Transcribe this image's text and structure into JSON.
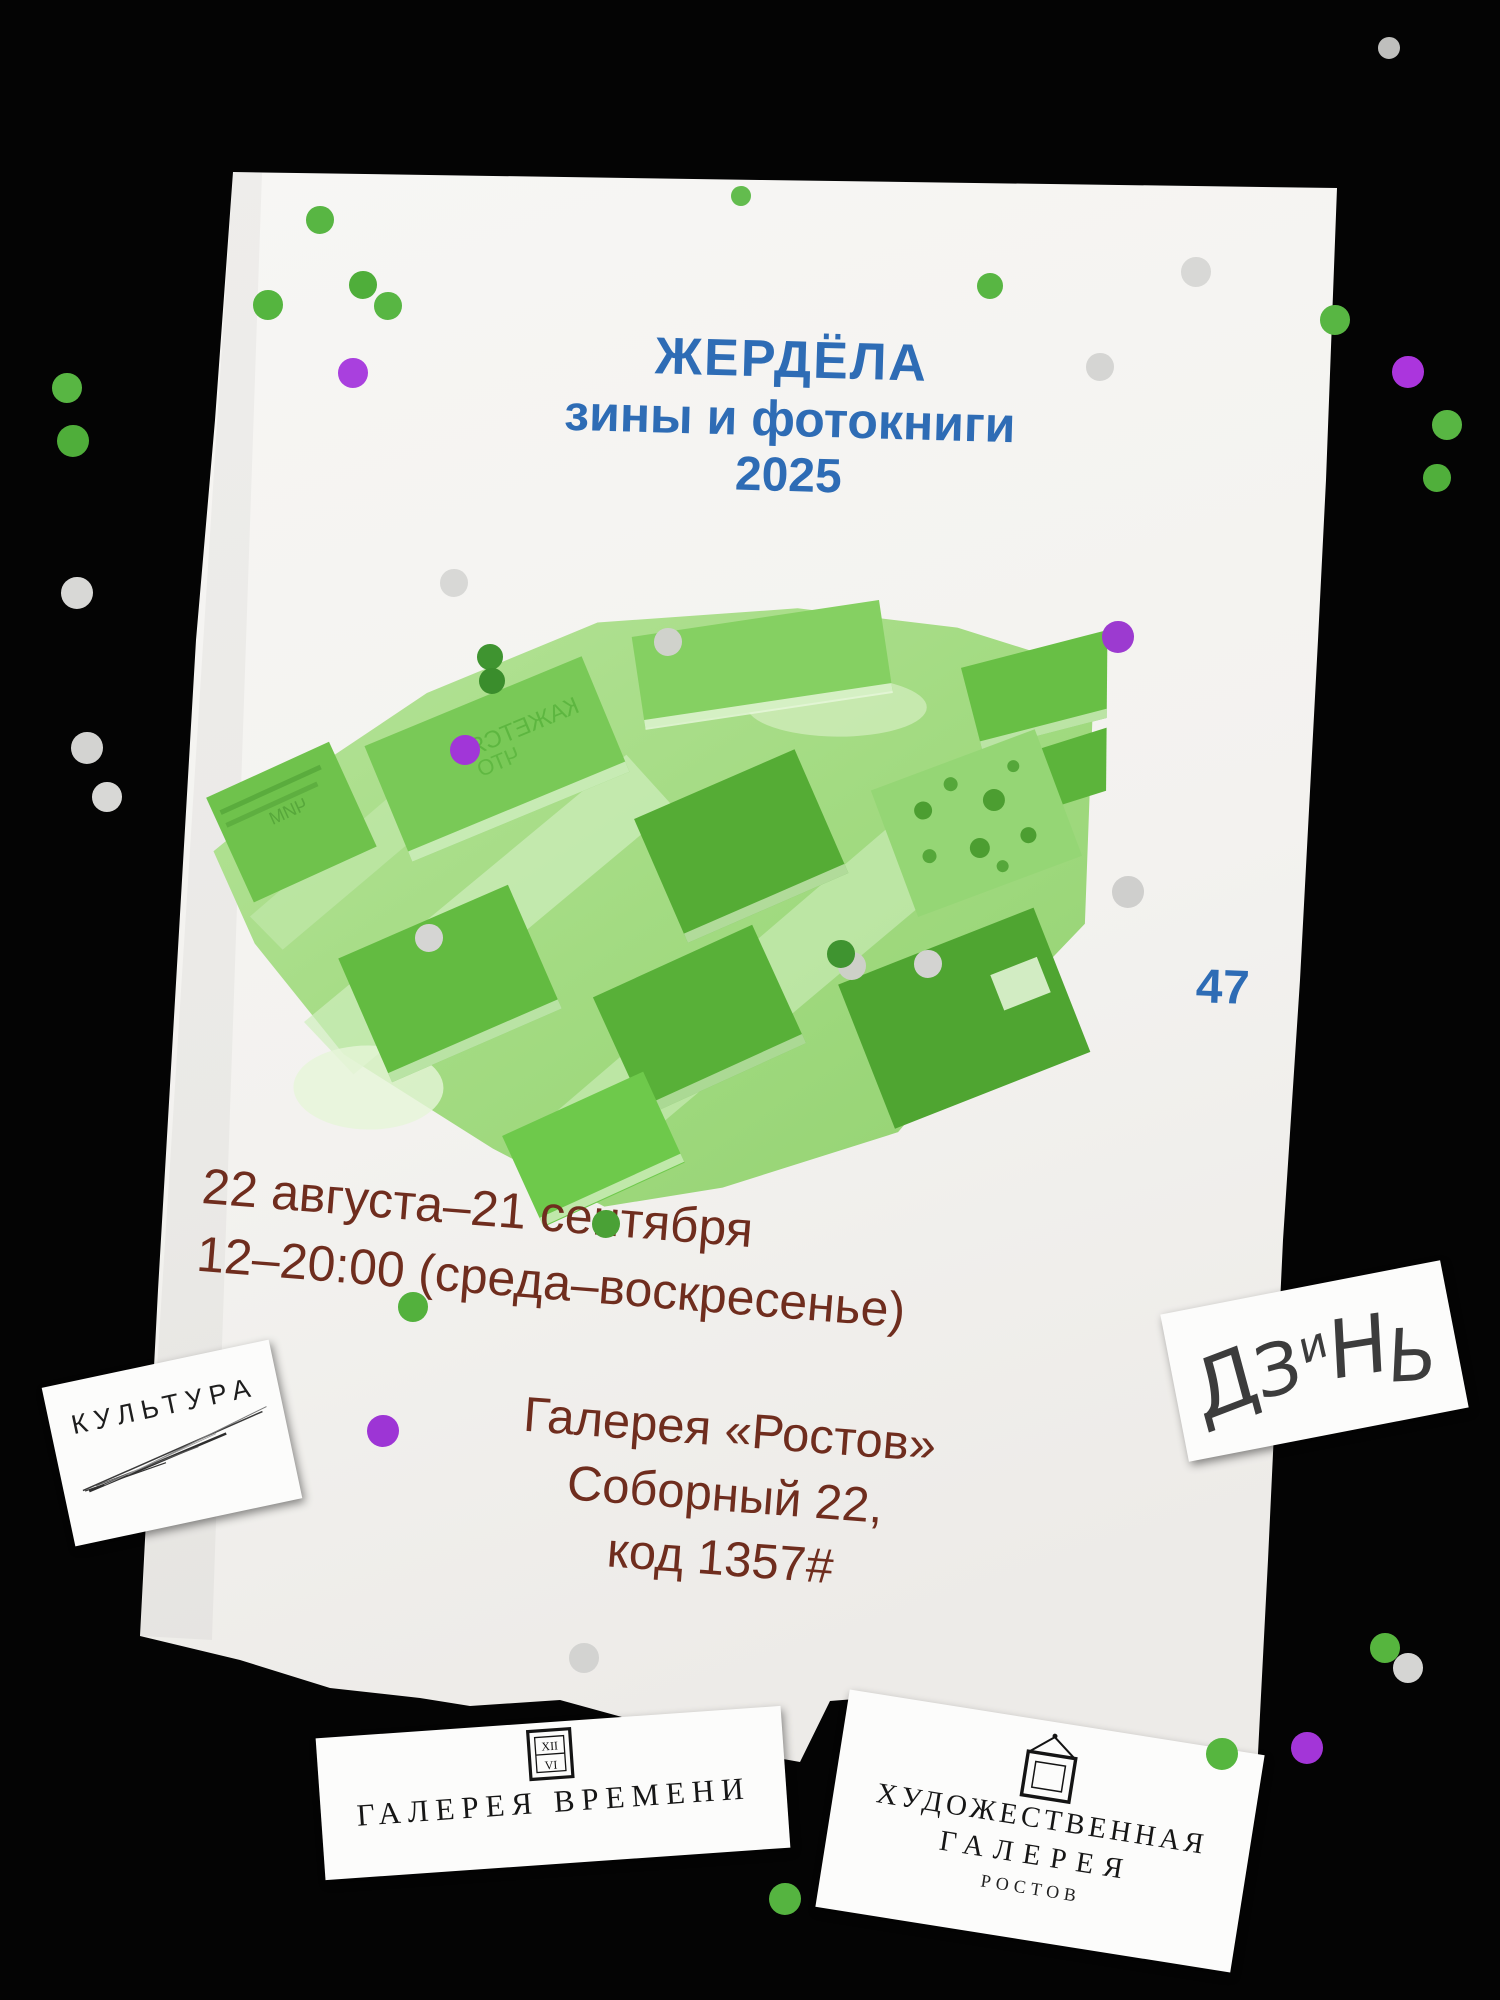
{
  "poster": {
    "title": {
      "line1": "ЖЕРДЁЛА",
      "line2": "зины и фотокниги",
      "line3": "2025"
    },
    "page_number": "47",
    "schedule": {
      "dates": "22 августа–21 сентября",
      "hours": "12–20:00 (среда–воскресенье)"
    },
    "venue": {
      "name": "Галерея «Ростов»",
      "address": "Соборный 22,",
      "entry_code": "код 1357#"
    },
    "photo": {
      "labels": {
        "book_text_1": "КАЖЕТСЯ",
        "book_text_2": "ЧТО",
        "book_text_3": "ЧИМ"
      }
    }
  },
  "cards": {
    "kultura": {
      "label": "КУЛЬТУРА"
    },
    "dzin": {
      "letters": [
        "Д",
        "З",
        "и",
        "Н",
        "Ь"
      ]
    },
    "galereya_vremeni": {
      "label": "ГАЛЕРЕЯ ВРЕМЕНИ",
      "clock_top": "XII",
      "clock_bottom": "VI"
    },
    "hud_galereya": {
      "line1": "ХУДОЖЕСТВЕННАЯ",
      "line2": "ГАЛЕРЕЯ",
      "line3": "РОСТОВ"
    }
  },
  "colors": {
    "background_black": "#040404",
    "paper_white": "#f4f3f0",
    "card_white": "#fcfcfb",
    "accent_blue": "#2e6cb5",
    "text_brown": "#6f2d1e",
    "photo_light_green": "#a5dc85",
    "photo_book_green": "#5eb53c",
    "confetti_green": "#58b643",
    "confetti_green_dark": "#3f9430",
    "confetti_purple": "#a236d8",
    "confetti_gray": "#d7d7d5"
  },
  "confetti": [
    {
      "x": 67,
      "y": 388,
      "r": 15,
      "c": "#58b643"
    },
    {
      "x": 73,
      "y": 441,
      "r": 16,
      "c": "#4fae3a"
    },
    {
      "x": 77,
      "y": 593,
      "r": 16,
      "c": "#d8d8d6"
    },
    {
      "x": 87,
      "y": 748,
      "r": 16,
      "c": "#d3d3d1"
    },
    {
      "x": 107,
      "y": 797,
      "r": 15,
      "c": "#d8d8d6"
    },
    {
      "x": 1389,
      "y": 48,
      "r": 11,
      "c": "#bfbfbd"
    },
    {
      "x": 1196,
      "y": 272,
      "r": 15,
      "c": "#d8d8d6"
    },
    {
      "x": 1100,
      "y": 367,
      "r": 14,
      "c": "#d5d5d3"
    },
    {
      "x": 1335,
      "y": 320,
      "r": 15,
      "c": "#58b643"
    },
    {
      "x": 1408,
      "y": 372,
      "r": 16,
      "c": "#ab35dd"
    },
    {
      "x": 1447,
      "y": 425,
      "r": 15,
      "c": "#58b643"
    },
    {
      "x": 1437,
      "y": 478,
      "r": 14,
      "c": "#50af3b"
    },
    {
      "x": 320,
      "y": 220,
      "r": 14,
      "c": "#58b643"
    },
    {
      "x": 268,
      "y": 305,
      "r": 15,
      "c": "#55b53f"
    },
    {
      "x": 363,
      "y": 285,
      "r": 14,
      "c": "#4fae3a"
    },
    {
      "x": 388,
      "y": 306,
      "r": 14,
      "c": "#58b643"
    },
    {
      "x": 353,
      "y": 373,
      "r": 15,
      "c": "#a940de"
    },
    {
      "x": 741,
      "y": 196,
      "r": 10,
      "c": "#63bc4e"
    },
    {
      "x": 990,
      "y": 286,
      "r": 13,
      "c": "#58b643"
    },
    {
      "x": 454,
      "y": 583,
      "r": 14,
      "c": "#d8d8d6"
    },
    {
      "x": 668,
      "y": 642,
      "r": 14,
      "c": "#d0d2cc"
    },
    {
      "x": 490,
      "y": 657,
      "r": 13,
      "c": "#3f9430"
    },
    {
      "x": 492,
      "y": 681,
      "r": 13,
      "c": "#3a8d2c"
    },
    {
      "x": 1118,
      "y": 637,
      "r": 16,
      "c": "#9c3ad0"
    },
    {
      "x": 1128,
      "y": 892,
      "r": 16,
      "c": "#cfcfcd"
    },
    {
      "x": 465,
      "y": 750,
      "r": 15,
      "c": "#a136d8"
    },
    {
      "x": 852,
      "y": 966,
      "r": 14,
      "c": "#cdd0c8"
    },
    {
      "x": 841,
      "y": 954,
      "r": 14,
      "c": "#3f9430"
    },
    {
      "x": 928,
      "y": 964,
      "r": 14,
      "c": "#d3d3d1"
    },
    {
      "x": 429,
      "y": 938,
      "r": 14,
      "c": "#d5d5d3"
    },
    {
      "x": 606,
      "y": 1224,
      "r": 14,
      "c": "#4aa136"
    },
    {
      "x": 413,
      "y": 1307,
      "r": 15,
      "c": "#53b13d"
    },
    {
      "x": 383,
      "y": 1431,
      "r": 16,
      "c": "#9d35d5"
    },
    {
      "x": 584,
      "y": 1658,
      "r": 15,
      "c": "#d3d3d1"
    },
    {
      "x": 785,
      "y": 1899,
      "r": 16,
      "c": "#55b440"
    },
    {
      "x": 1222,
      "y": 1754,
      "r": 16,
      "c": "#56b63f"
    },
    {
      "x": 1385,
      "y": 1648,
      "r": 15,
      "c": "#56b53e"
    },
    {
      "x": 1408,
      "y": 1668,
      "r": 15,
      "c": "#d5d5d3"
    },
    {
      "x": 1307,
      "y": 1748,
      "r": 16,
      "c": "#a335d8"
    }
  ]
}
